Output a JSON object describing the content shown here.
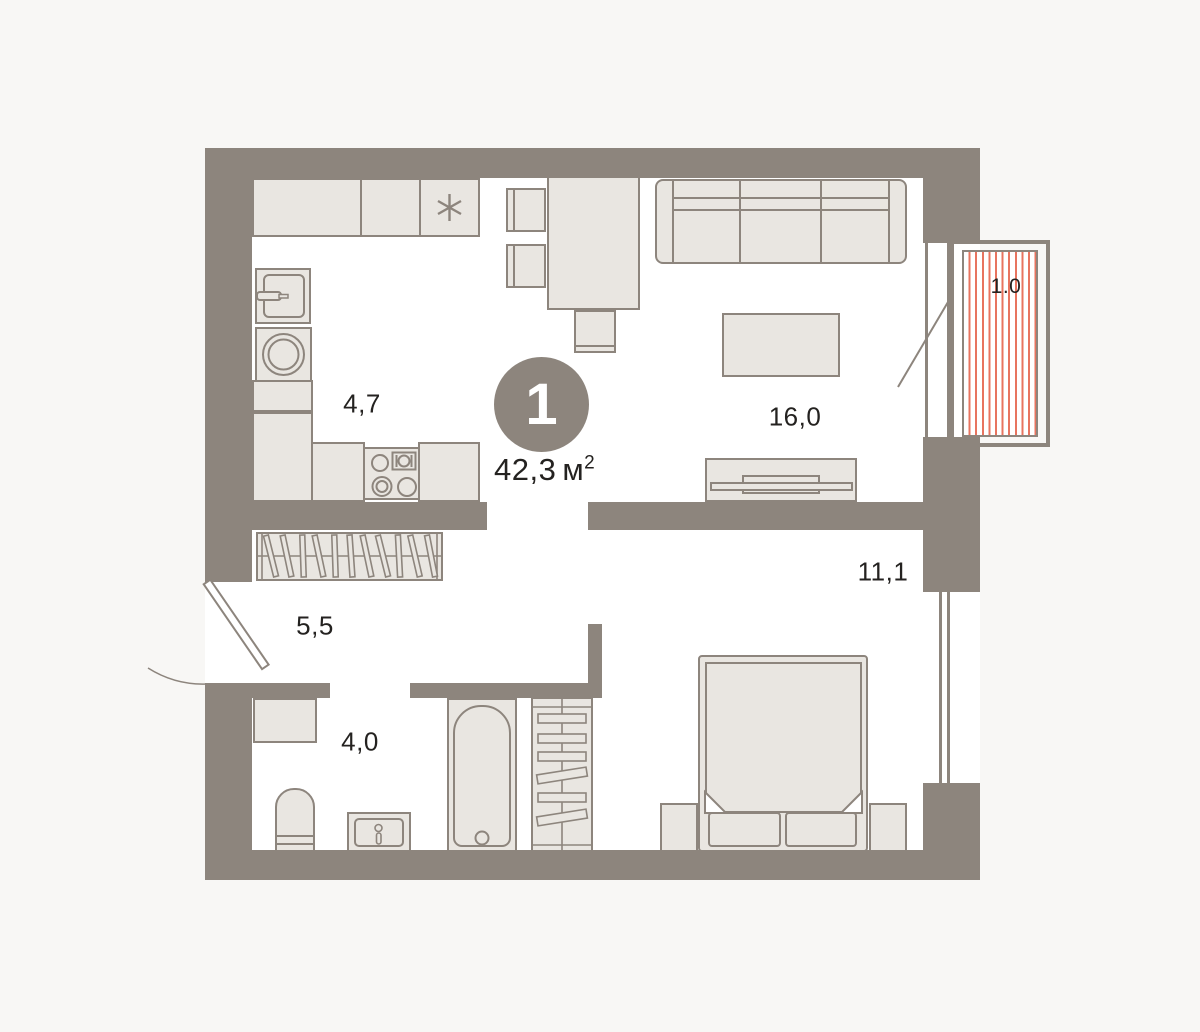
{
  "apartment": {
    "number": "1",
    "total_area_value": "42,3",
    "total_area_unit": "м",
    "total_area_sup": "2",
    "rooms": {
      "kitchen": {
        "name": "kitchen",
        "area": "4,7"
      },
      "living_room": {
        "name": "living-room",
        "area": "16,0"
      },
      "bedroom": {
        "name": "bedroom",
        "area": "11,1"
      },
      "hallway": {
        "name": "hallway",
        "area": "5,5"
      },
      "bathroom": {
        "name": "bathroom",
        "area": "4,0"
      },
      "balcony": {
        "name": "balcony",
        "area": "1.0"
      }
    }
  },
  "colors": {
    "wall": "#8d857d",
    "outline": "#8d857d",
    "furniture-fill": "#e9e6e1",
    "stripe": "#e8745f",
    "background": "#f8f7f5",
    "interior": "#ffffff",
    "text": "#242220"
  }
}
